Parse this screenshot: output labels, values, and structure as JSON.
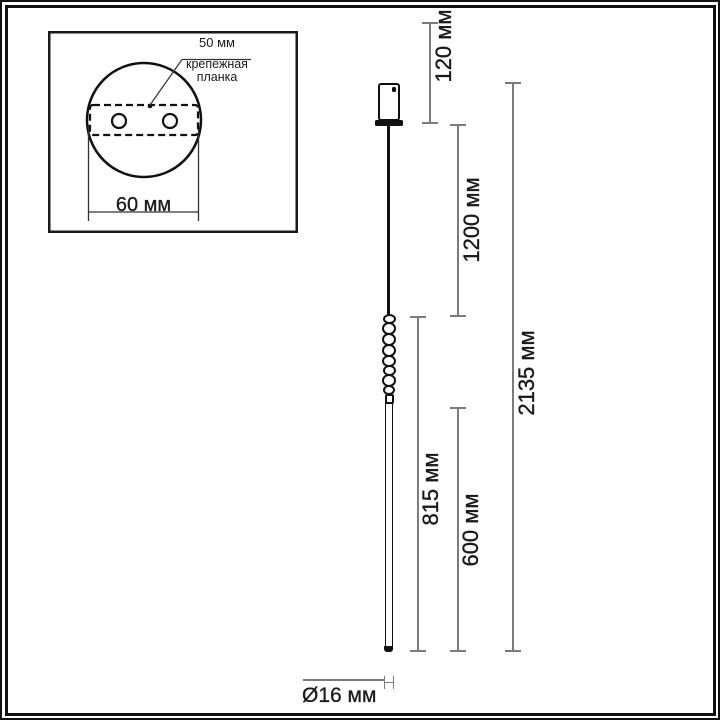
{
  "inset": {
    "offset_label": "50 мм",
    "caption_line1": "крепежная",
    "caption_line2": "планка",
    "width_label": "60 мм"
  },
  "dimensions": {
    "canopy_height": "120 мм",
    "cable_length": "1200 мм",
    "total_height": "2135 мм",
    "decorative_section": "815 мм",
    "tube_section": "600 мм",
    "tube_diameter": "Ø16 мм"
  },
  "colors": {
    "drawing_line": "#111111",
    "dimension_line": "#7b7b7b",
    "text": "#1a1a1a",
    "background": "#ffffff"
  }
}
